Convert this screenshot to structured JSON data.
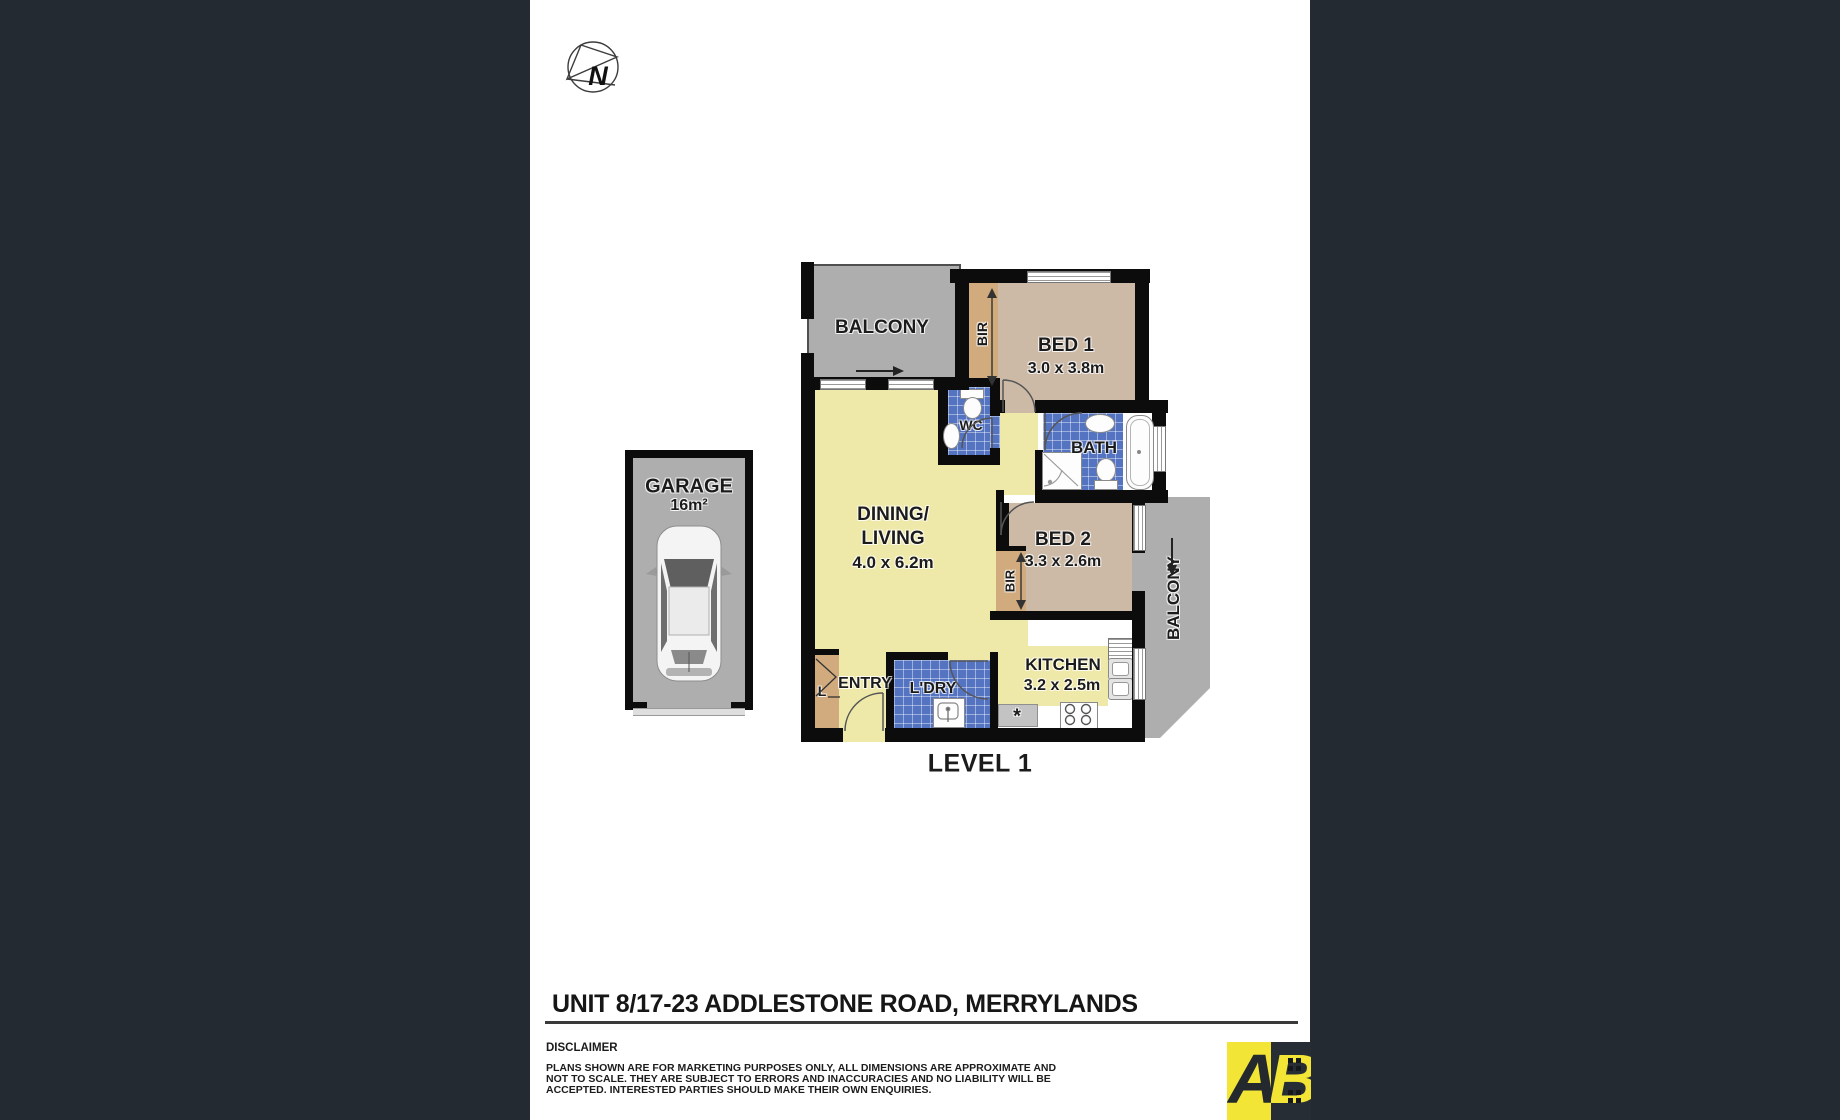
{
  "compass": {
    "label": "N"
  },
  "floor_plan": {
    "level_label": "LEVEL 1",
    "garage": {
      "label": "GARAGE",
      "area": "16m²"
    },
    "balcony_top": {
      "label": "BALCONY"
    },
    "balcony_right": {
      "label": "BALCONY"
    },
    "bed1": {
      "label": "BED 1",
      "dims": "3.0 x 3.8m",
      "bir_label": "BIR"
    },
    "bed2": {
      "label": "BED 2",
      "dims": "3.3 x 2.6m",
      "bir_label": "BIR"
    },
    "wc": {
      "label": "WC"
    },
    "bath": {
      "label": "BATH"
    },
    "living": {
      "label_line1": "DINING/",
      "label_line2": "LIVING",
      "dims": "4.0 x 6.2m"
    },
    "kitchen": {
      "label": "KITCHEN",
      "dims": "3.2 x 2.5m",
      "marker": "*"
    },
    "laundry": {
      "label": "L'DRY"
    },
    "entry": {
      "label": "ENTRY",
      "linen_label": "L"
    }
  },
  "footer": {
    "title": "UNIT 8/17-23 ADDLESTONE ROAD, MERRYLANDS",
    "disclaimer_heading": "DISCLAIMER",
    "disclaimer_lines": [
      "PLANS SHOWN ARE FOR MARKETING PURPOSES ONLY, ALL DIMENSIONS ARE APPROXIMATE AND",
      "NOT TO SCALE. THEY ARE SUBJECT TO ERRORS AND INACCURACIES AND NO LIABILITY WILL BE",
      "ACCEPTED. INTERESTED PARTIES SHOULD MAKE THEIR OWN ENQUIRIES."
    ]
  },
  "logo": {
    "letter_left": "A",
    "letter_right": "B"
  },
  "colors": {
    "background": "#232a32",
    "page": "#ffffff",
    "walls": "#0c0c0c",
    "living_floor": "#efe9a9",
    "bedroom_floor": "#ccbaa7",
    "wardrobe": "#d1ab7d",
    "tiles": "#5473c1",
    "balcony": "#aeaeae",
    "logo_yellow": "#f2e535"
  }
}
